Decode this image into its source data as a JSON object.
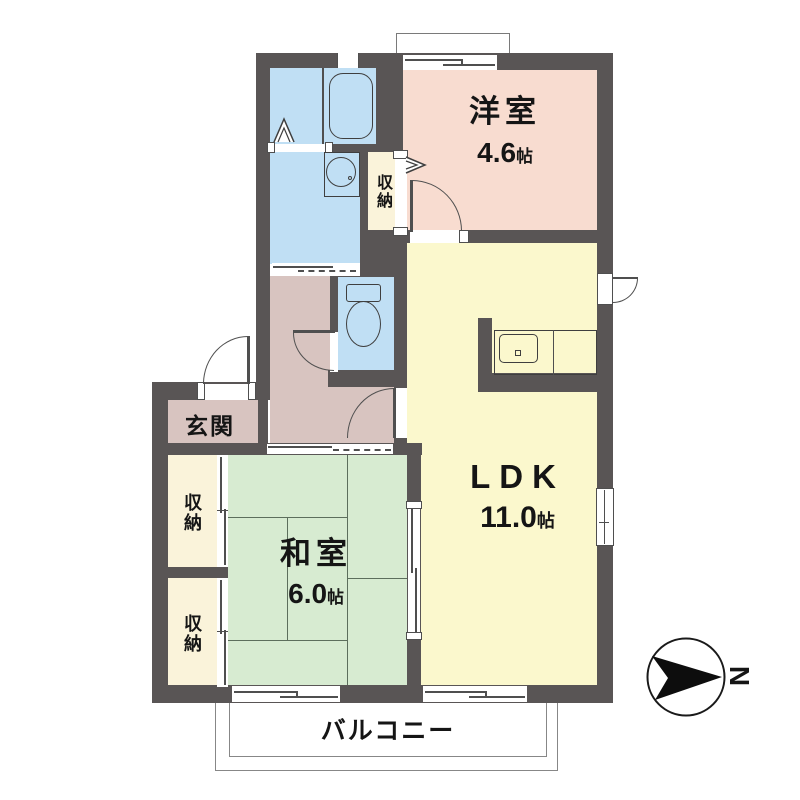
{
  "palette": {
    "wall": "#595555",
    "western_room": "#f8dcd0",
    "ldk": "#fbf8cd",
    "japanese_room": "#d7ebd1",
    "storage": "#faf3da",
    "wet_area": "#c0dff4",
    "hall_entrance": "#d8c4c0",
    "outline": "#3f3f3f"
  },
  "rooms": {
    "western": {
      "name": "洋室",
      "area": "4.6",
      "unit": "帖"
    },
    "ldk": {
      "name": "LDK",
      "area": "11.0",
      "unit": "帖"
    },
    "japanese": {
      "name": "和室",
      "area": "6.0",
      "unit": "帖"
    },
    "entrance": {
      "name": "玄関"
    },
    "balcony": {
      "name": "バルコニー"
    },
    "storage": {
      "name": "収納"
    }
  },
  "compass": {
    "north_label": "N"
  }
}
